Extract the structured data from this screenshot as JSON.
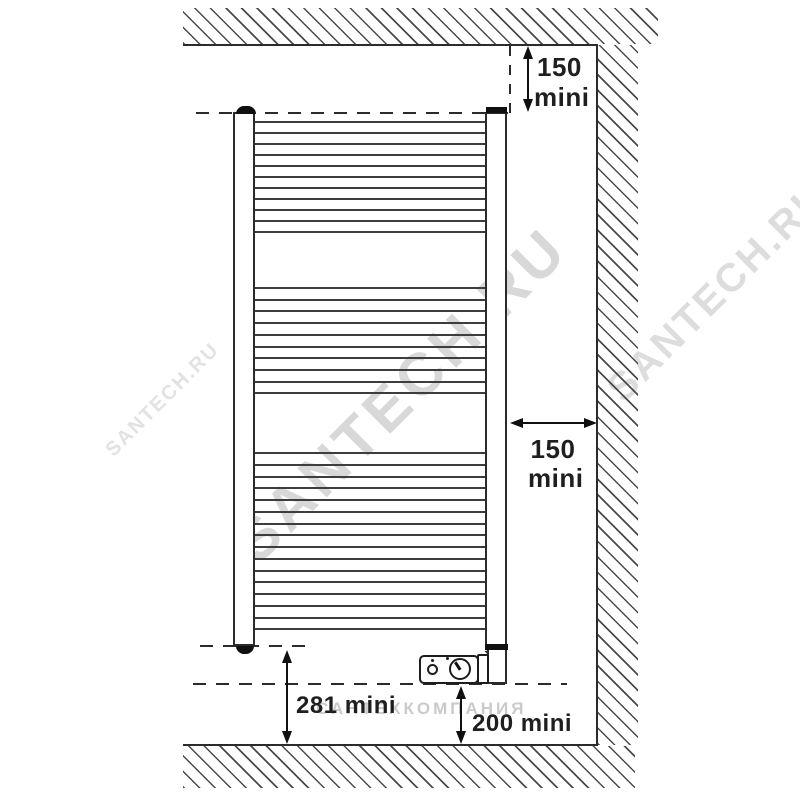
{
  "figure": {
    "type": "installation-clearance-diagram",
    "subject": "electric-towel-rail-radiator",
    "dimensions": {
      "top": {
        "value": "150",
        "unit": "mini"
      },
      "side": {
        "value": "150",
        "unit": "mini"
      },
      "bottom_left": {
        "value": "281",
        "unit": "mini"
      },
      "bottom_right": {
        "value": "200",
        "unit": "mini"
      }
    },
    "radiator": {
      "rung_groups": [
        {
          "count": 11,
          "y_start": 121,
          "step": 11.0
        },
        {
          "count": 10,
          "y_start": 287,
          "step": 11.7
        },
        {
          "count": 16,
          "y_start": 452,
          "step": 11.75
        }
      ]
    },
    "colors": {
      "line": "#2b2b2b",
      "watermark_gray": "#7d7d7d"
    }
  },
  "watermarks": {
    "main": "SANTECH.RU",
    "small_left": "SANTECH.RU",
    "fragment_right": "SANTECH.RU",
    "horizontal": "САНТЕХКОМПАНИЯ"
  }
}
